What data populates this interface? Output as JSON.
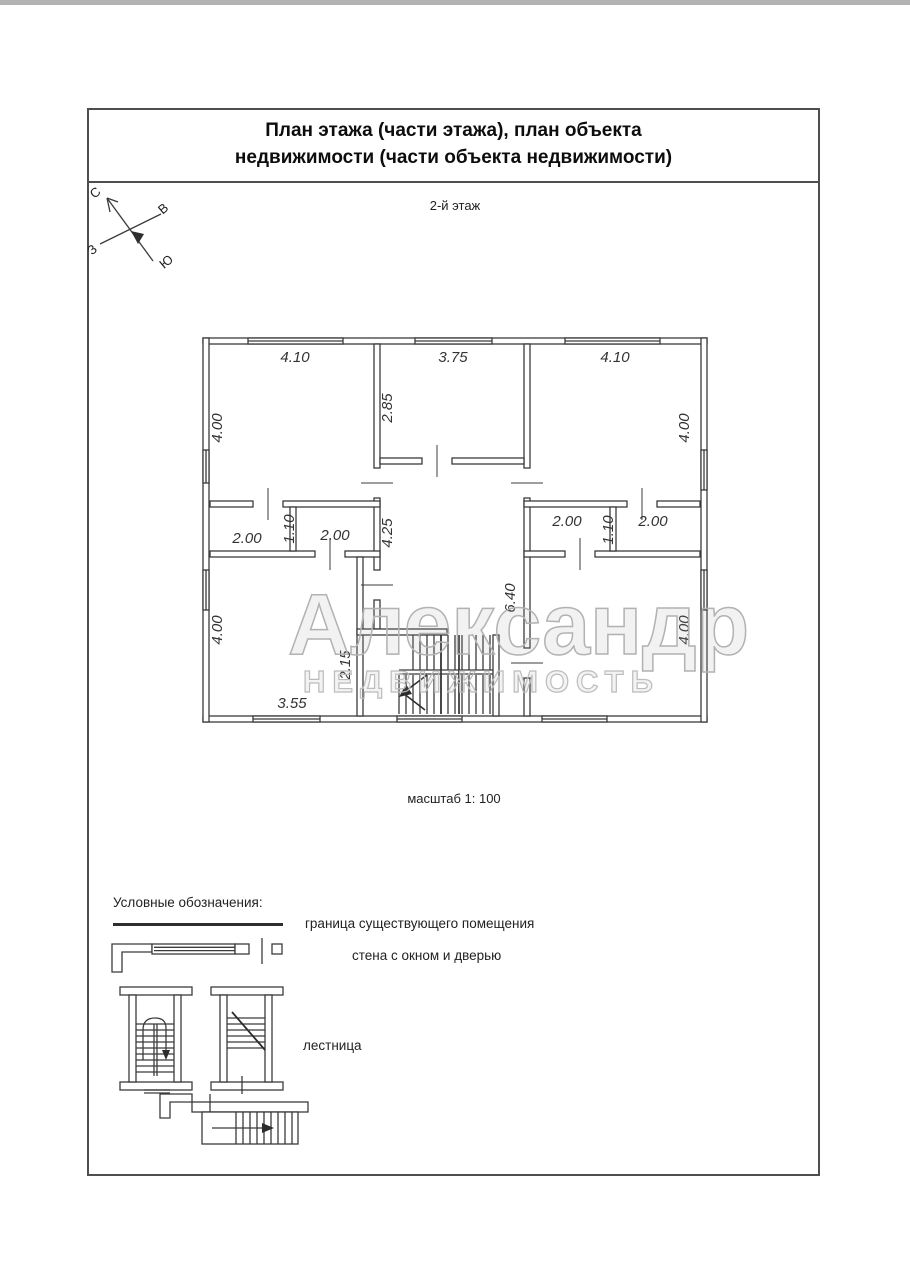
{
  "page": {
    "title_line1": "План этажа (части этажа), план объекта",
    "title_line2": "недвижимости (части объекта недвижимости)",
    "floor_label": "2-й этаж",
    "scale_label": "масштаб 1: 100"
  },
  "compass": {
    "n": "С",
    "e": "В",
    "w": "З",
    "s": "Ю"
  },
  "plan": {
    "dims": {
      "tl_w": "4.10",
      "tm_w": "3.75",
      "tr_w": "4.10",
      "tl_h": "4.00",
      "tm_h": "2.85",
      "tr_h": "4.00",
      "lc_a": "2.00",
      "lc_h": "1.10",
      "lc_b": "2.00",
      "rc_a": "2.00",
      "rc_h": "1.10",
      "rc_b": "2.00",
      "hall_h": "4.25",
      "hall_total": "6.40",
      "bl_h": "4.00",
      "br_h": "4.00",
      "stair_h": "2.15",
      "bl_w": "3.55"
    }
  },
  "watermark": {
    "line1": "Александр",
    "line2": "НЕДВИЖИМОСТЬ"
  },
  "legend": {
    "heading": "Условные обозначения:",
    "items": [
      {
        "label": "граница существующего помещения"
      },
      {
        "label": "стена с окном и дверью"
      },
      {
        "label": "лестница"
      }
    ]
  }
}
